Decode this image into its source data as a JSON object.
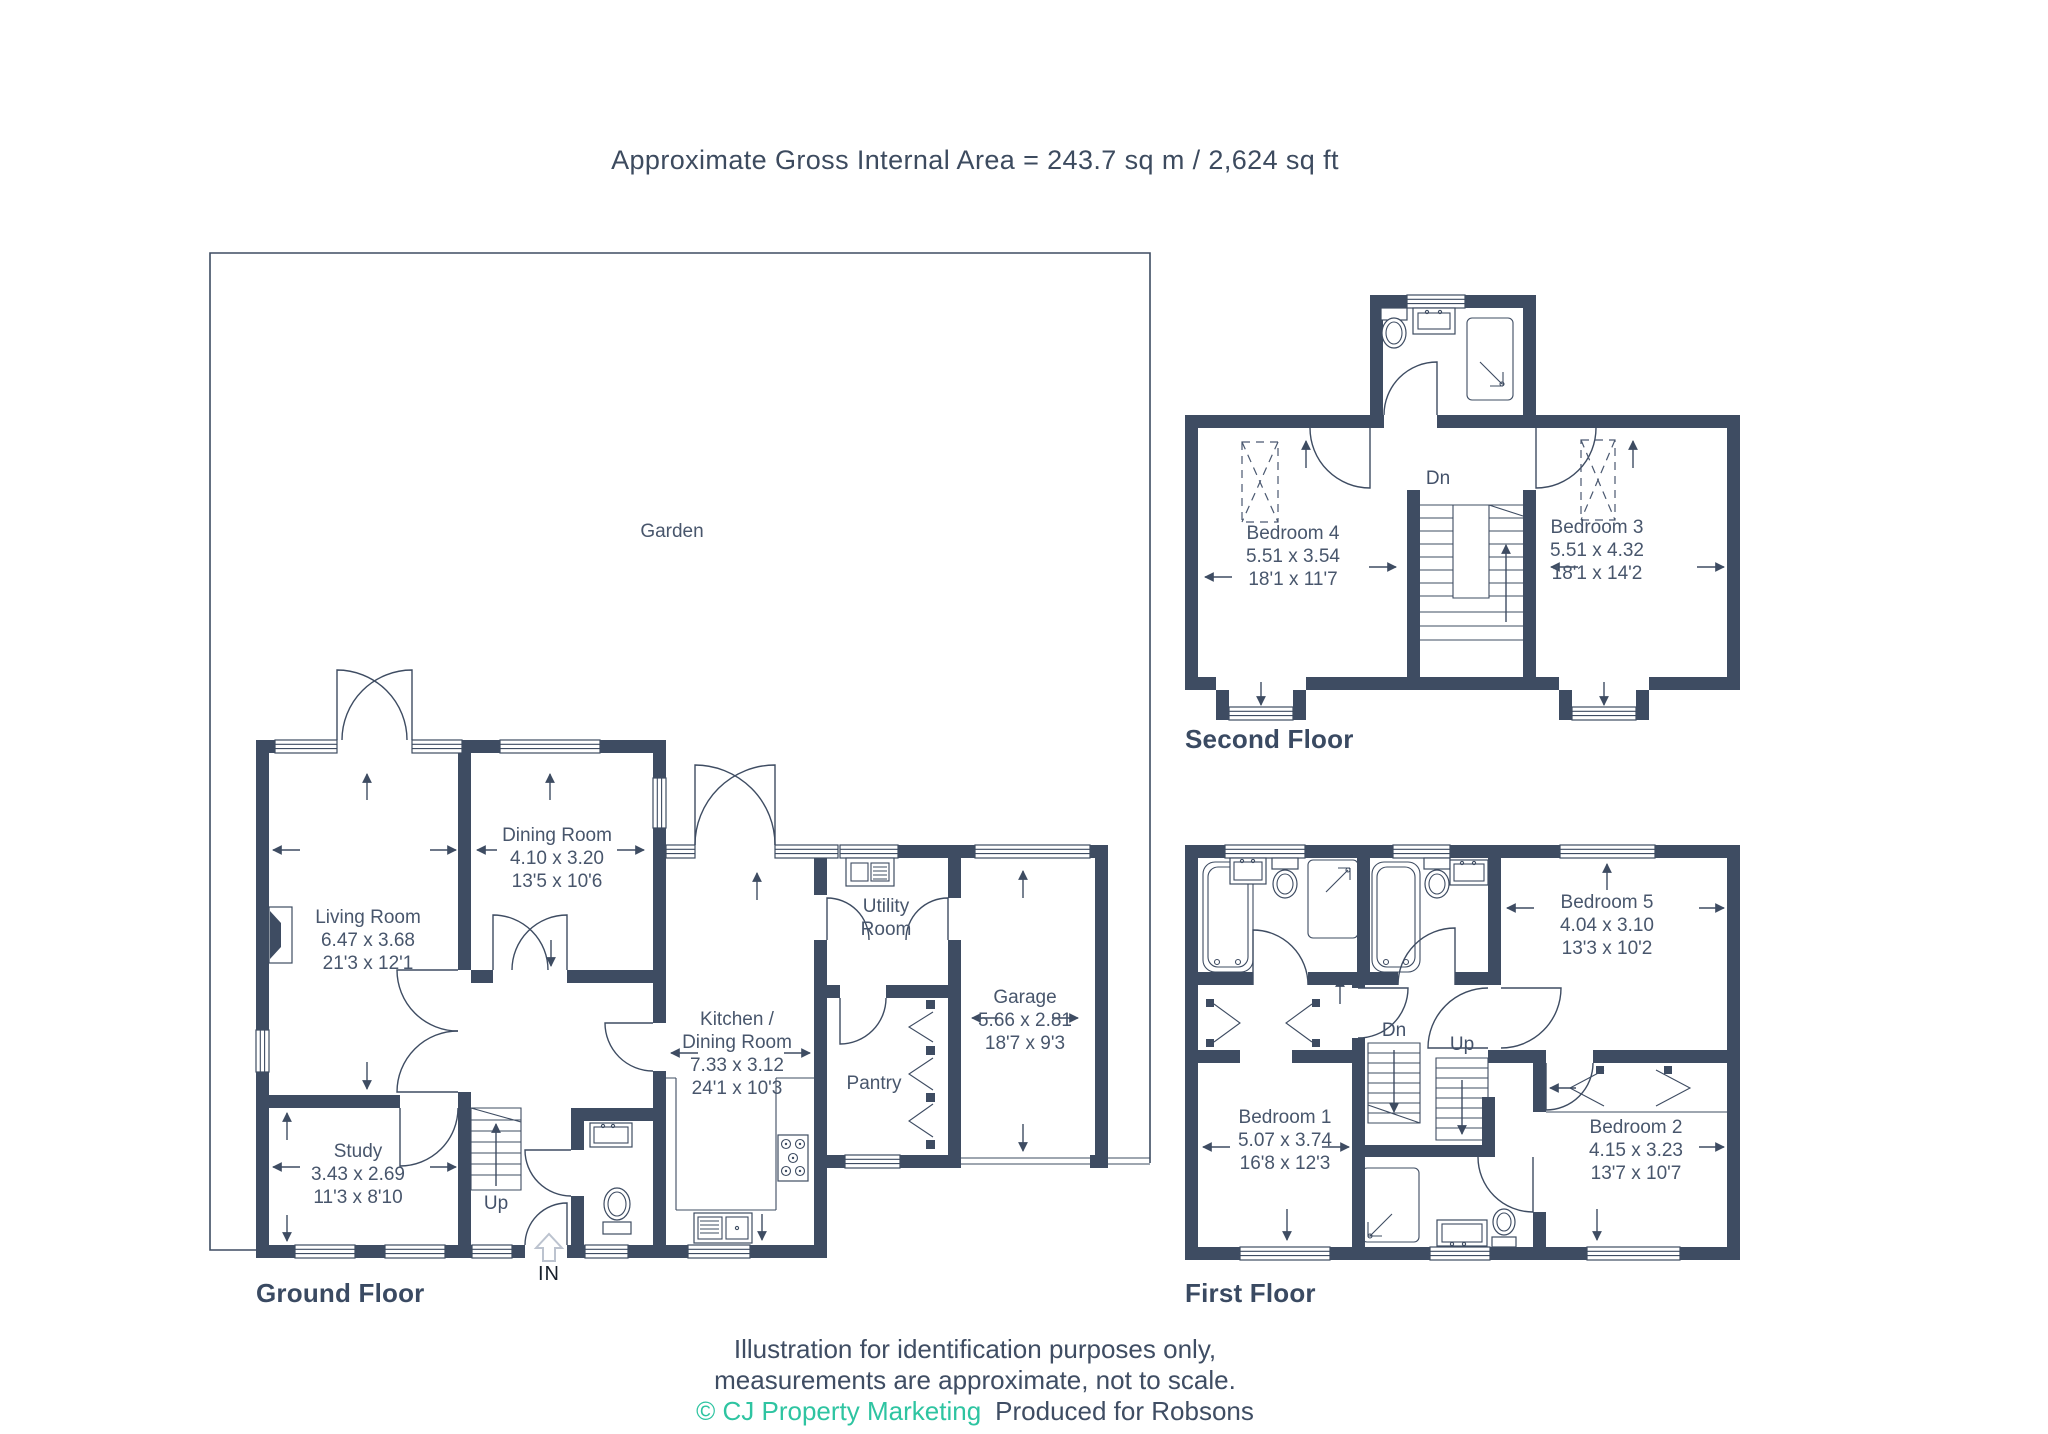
{
  "title": "Approximate Gross Internal Area = 243.7 sq m / 2,624 sq ft",
  "colors": {
    "wall": "#3e4c62",
    "label_text": "#48566c",
    "floor_label": "#3a4a62",
    "teal": "#2ec4a1",
    "entrance_arrow": "#bcc3cf"
  },
  "garden": {
    "label": "Garden"
  },
  "floors": {
    "ground": {
      "label": "Ground Floor",
      "stairs_up": "Up",
      "entrance": "IN",
      "rooms": {
        "living": {
          "name": "Living Room",
          "metric": "6.47 x 3.68",
          "imperial": "21'3 x 12'1"
        },
        "dining": {
          "name": "Dining Room",
          "metric": "4.10 x 3.20",
          "imperial": "13'5 x 10'6"
        },
        "study": {
          "name": "Study",
          "metric": "3.43 x 2.69",
          "imperial": "11'3 x 8'10"
        },
        "kitchen": {
          "name": "Kitchen / Dining Room",
          "metric": "7.33 x 3.12",
          "imperial": "24'1 x 10'3"
        },
        "utility": {
          "name": "Utility Room"
        },
        "pantry": {
          "name": "Pantry"
        },
        "garage": {
          "name": "Garage",
          "metric": "5.66 x 2.81",
          "imperial": "18'7 x 9'3"
        }
      }
    },
    "first": {
      "label": "First Floor",
      "stairs_down": "Dn",
      "stairs_up": "Up",
      "rooms": {
        "bedroom1": {
          "name": "Bedroom 1",
          "metric": "5.07 x 3.74",
          "imperial": "16'8 x 12'3"
        },
        "bedroom2": {
          "name": "Bedroom 2",
          "metric": "4.15 x 3.23",
          "imperial": "13'7 x 10'7"
        },
        "bedroom5": {
          "name": "Bedroom 5",
          "metric": "4.04 x 3.10",
          "imperial": "13'3 x 10'2"
        }
      }
    },
    "second": {
      "label": "Second Floor",
      "stairs_down": "Dn",
      "rooms": {
        "bedroom3": {
          "name": "Bedroom 3",
          "metric": "5.51 x 4.32",
          "imperial": "18'1 x 14'2"
        },
        "bedroom4": {
          "name": "Bedroom 4",
          "metric": "5.51 x 3.54",
          "imperial": "18'1 x 11'7"
        }
      }
    }
  },
  "footer": {
    "line1": "Illustration for identification purposes only,",
    "line2": "measurements are approximate, not to scale.",
    "copyright": "© CJ Property Marketing",
    "produced": "Produced for Robsons"
  }
}
